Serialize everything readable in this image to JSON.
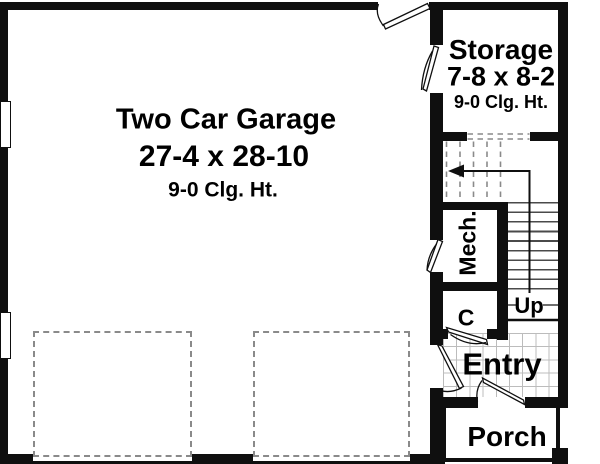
{
  "plan_title": "Garage Floor Plan",
  "rooms": {
    "garage": {
      "name": "Two Car Garage",
      "dims": "27-4 x 28-10",
      "ceiling": "9-0 Clg. Ht."
    },
    "storage": {
      "name": "Storage",
      "dims": "7-8 x 8-2",
      "ceiling": "9-0 Clg. Ht."
    },
    "mech": {
      "name": "Mech."
    },
    "closet": {
      "name": "C"
    },
    "stairs": {
      "direction_label": "Up"
    },
    "entry": {
      "name": "Entry"
    },
    "porch": {
      "name": "Porch"
    }
  },
  "colors": {
    "wall": "#0f0f0f",
    "background": "#ffffff",
    "dashed_lines": "#8a8a8a",
    "stair_treads": "#4a4a4a",
    "tile_grid": "#bcbcbc"
  }
}
